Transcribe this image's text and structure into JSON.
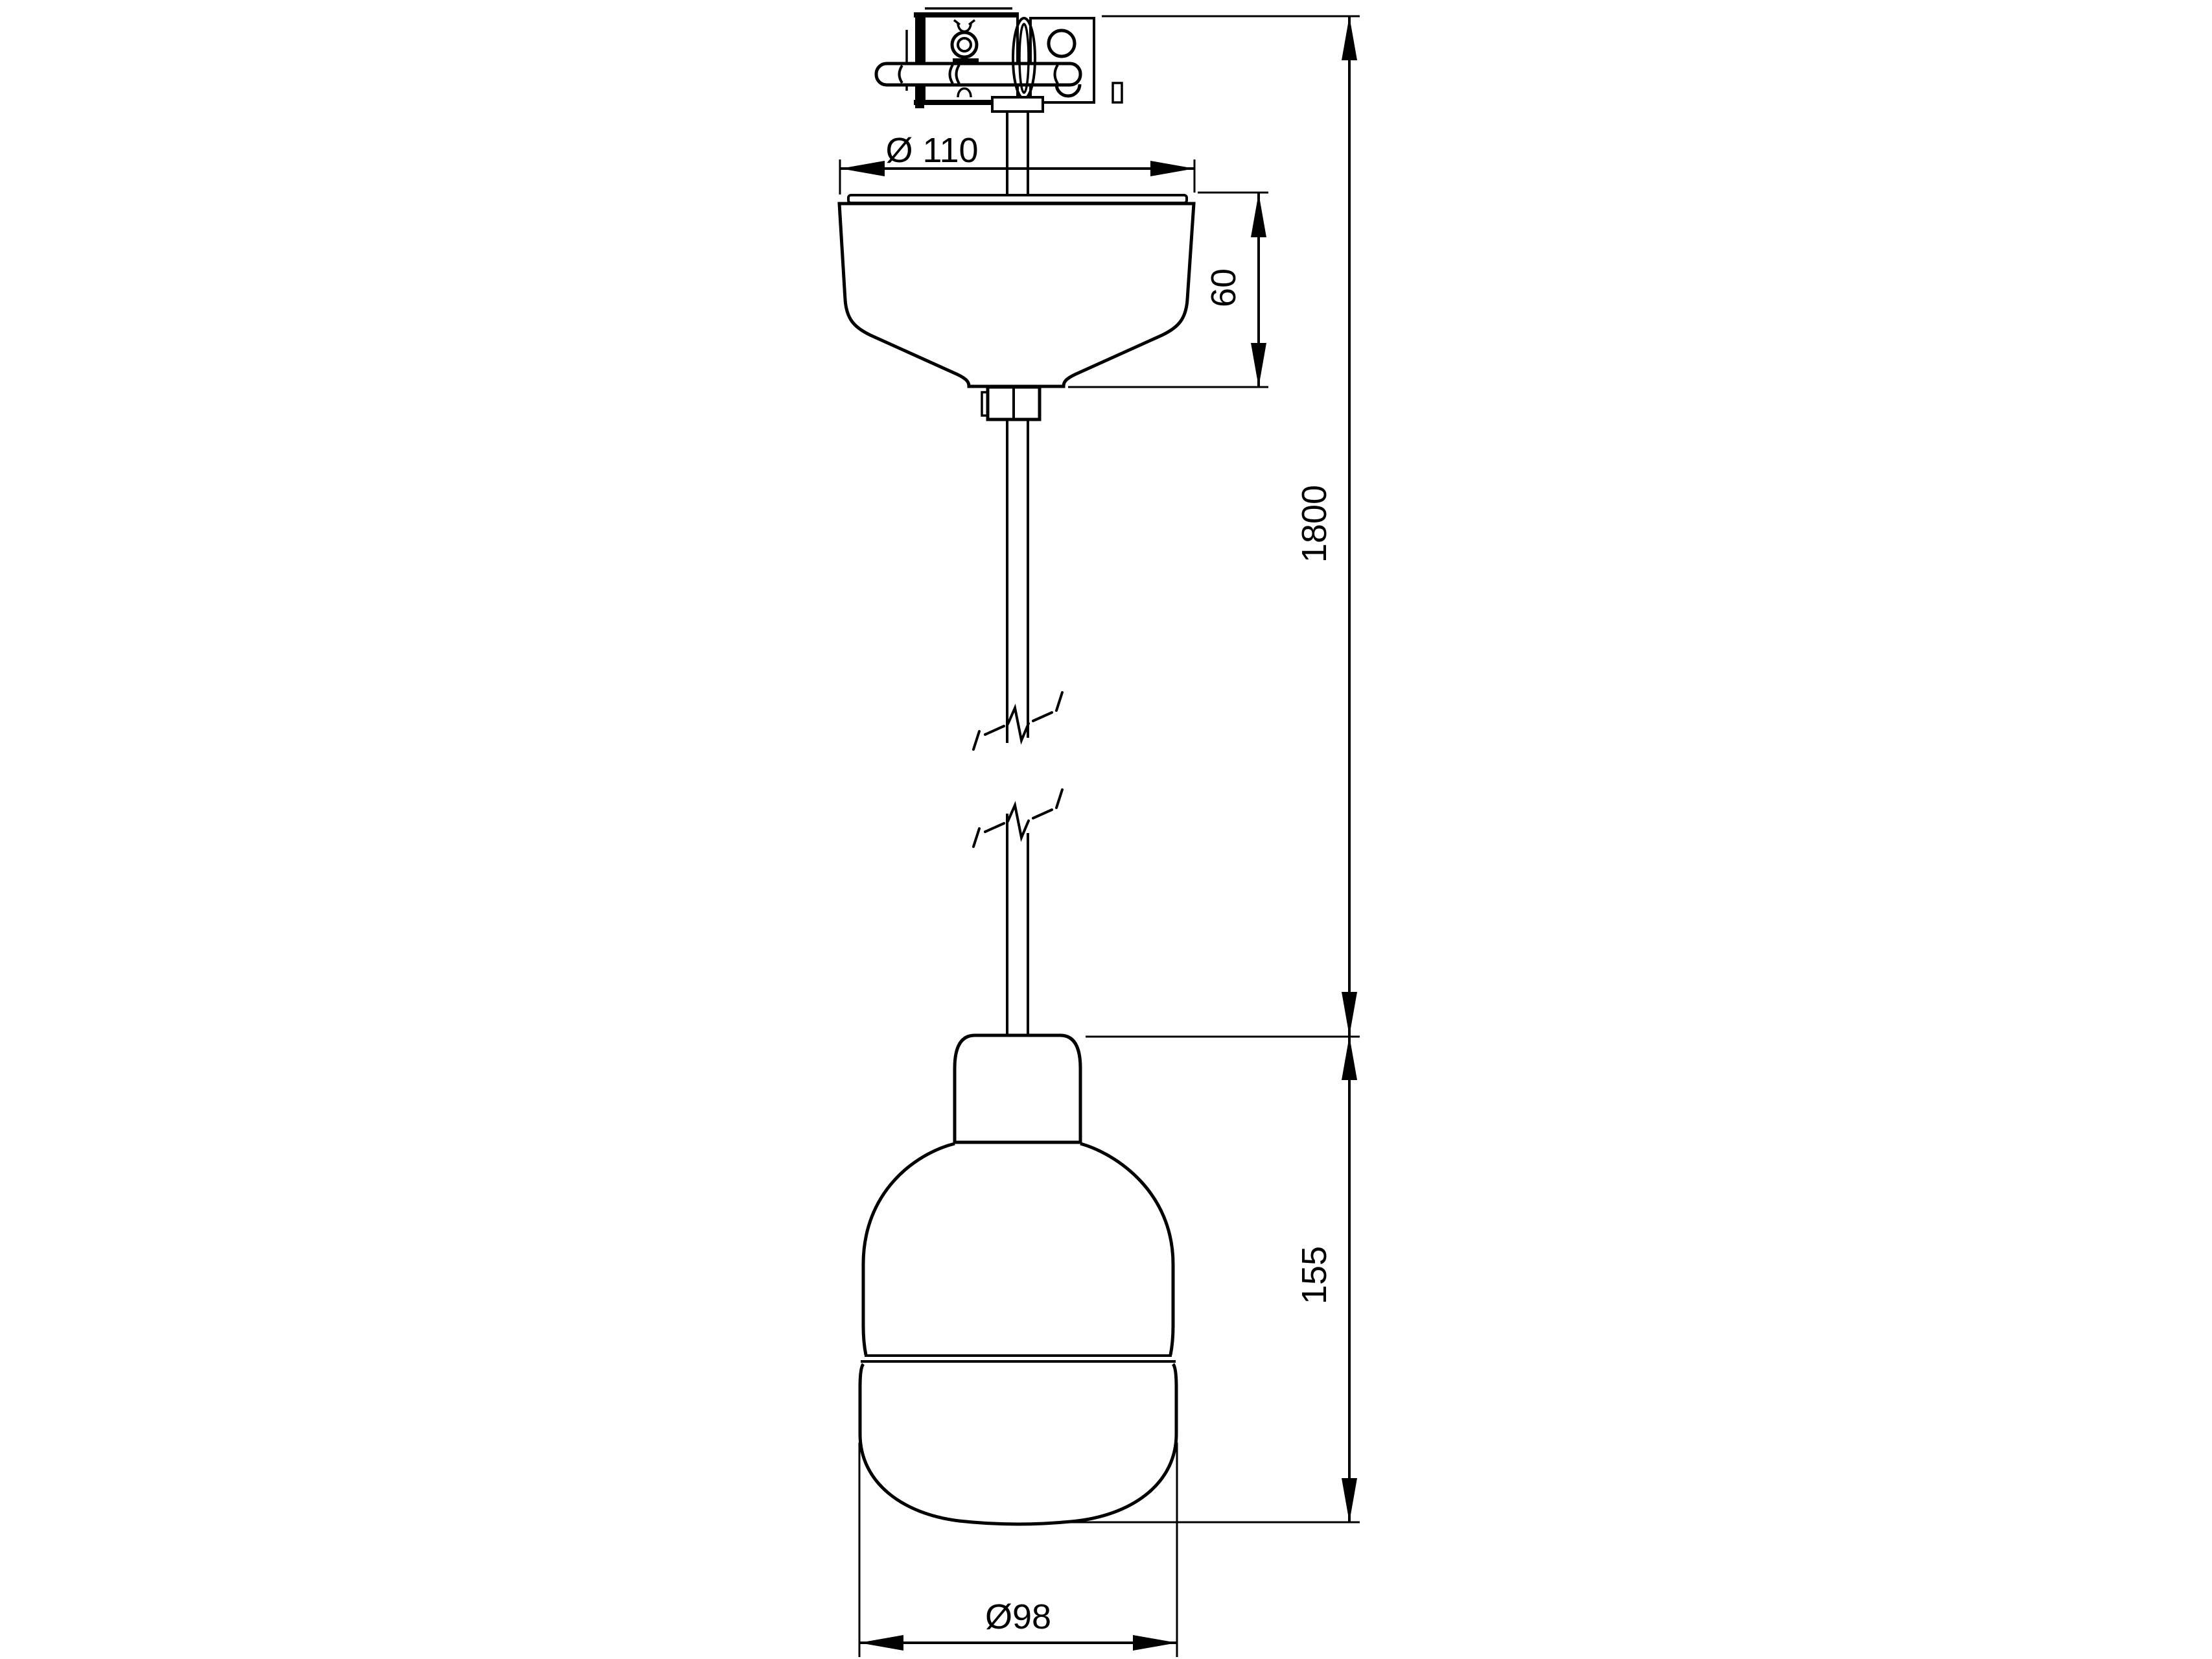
{
  "drawing": {
    "kind": "technical dimension drawing",
    "subject": "pendant lamp with ceiling canopy and suspension cable",
    "background_color": "#ffffff",
    "line_color": "#000000",
    "components": [
      "ceiling-mount-bracket",
      "suspension-cable",
      "cable-break-symbol",
      "ceiling-canopy",
      "lamp-socket-cap",
      "lamp-shade-body",
      "glass-diffuser"
    ]
  },
  "dimensions": {
    "canopy_diameter": "Ø 110",
    "canopy_height": "60",
    "suspension_length": "1800",
    "shade_height": "155",
    "shade_diameter": "Ø98"
  }
}
